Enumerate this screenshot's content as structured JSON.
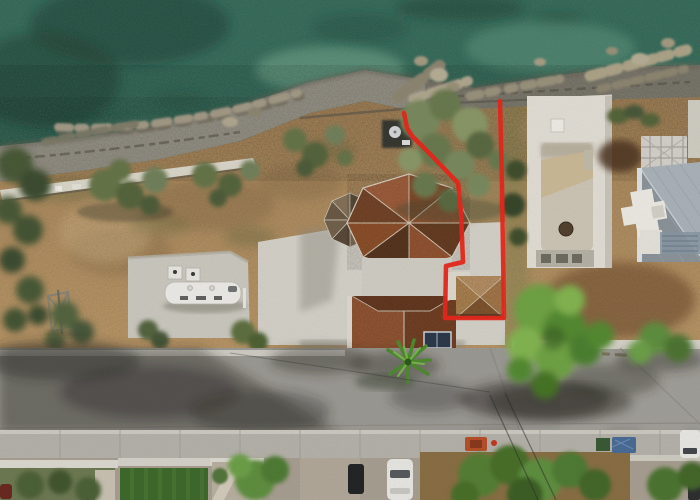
{
  "scene": {
    "type": "aerial-drone-photo",
    "description": "Top-down aerial photograph of a seafront villa plot outlined with a red boundary line; turquoise sea and pebble beach at top, olive trees and dry fields, a villa with octagonal terracotta hip roof, a neighbouring white deck with empty pool, a grey-roofed modern house with scaffolding, and an asphalt street with tree shadows and parked cars at the bottom",
    "annotation": {
      "kind": "property-boundary",
      "color": "#e8281c",
      "shape": "open red polyline running from the beach, around the villa annex, back to the beach"
    }
  },
  "colors": {
    "sea_deep": "#2e6453",
    "sea_mid": "#417f68",
    "reef_dark": "#17392e",
    "beach_pebble": "#9a968a",
    "beach_dark": "#827e72",
    "beach_wet": "#6b675c",
    "rock_light": "#b7ae96",
    "rock_mid": "#a39a86",
    "rock_dark": "#6e6a5a",
    "dirt_field": "#b8956a",
    "dirt_dark": "#8a6d48",
    "dirt_rich": "#7d5a36",
    "olive_tree": "#66744a",
    "olive_dark": "#4a5a38",
    "bright_tree": "#6fa344",
    "roof_terracotta": "#9c5a36",
    "roof_annex": "#b08050",
    "concrete": "#d4d1c8",
    "pad_concrete": "#cbc8bf",
    "deck_white": "#e2ded5",
    "pool_basin": "#cdc5b5",
    "pool_sand": "#cbb894",
    "modern_roof_light": "#aab3b9",
    "modern_roof_dark": "#8b949a",
    "road_asphalt": "#9c9a94",
    "shadow": "#2f2e28",
    "sidewalk": "#b5b2aa",
    "lawn": "#3f6a2c",
    "caravan_white": "#ecebe7",
    "suv_black": "#1c1e20",
    "car_white": "#e8e7e3",
    "tarp_blue": "#4a6c96",
    "boundary_red": "#e8281c"
  },
  "objects": {
    "sea": "calm green-turquoise water with dark seagrass reef patches",
    "beach": "narrow pebble beach with scattered boulders along the waterline",
    "main_house": "villa with multi-faceted octagonal terracotta tile roof",
    "annex": "small hip-roofed annex enclosed by the red boundary box",
    "pool_deck": "white roof deck with empty rectangular pool basin",
    "modern_house": "neighbour house with grey ribbed metal roof and white scaffolding",
    "caravan": "white caravan parked on a concrete pad",
    "vehicles": [
      "black SUV beside villa",
      "dark pickup on driveway",
      "white car at kerb",
      "white van far right",
      "dark car bottom-right",
      "maroon car bottom-left"
    ],
    "road": "asphalt street crossed by long tree shadows and overhead wires",
    "palm": "small palm tree at the villa street entrance"
  }
}
